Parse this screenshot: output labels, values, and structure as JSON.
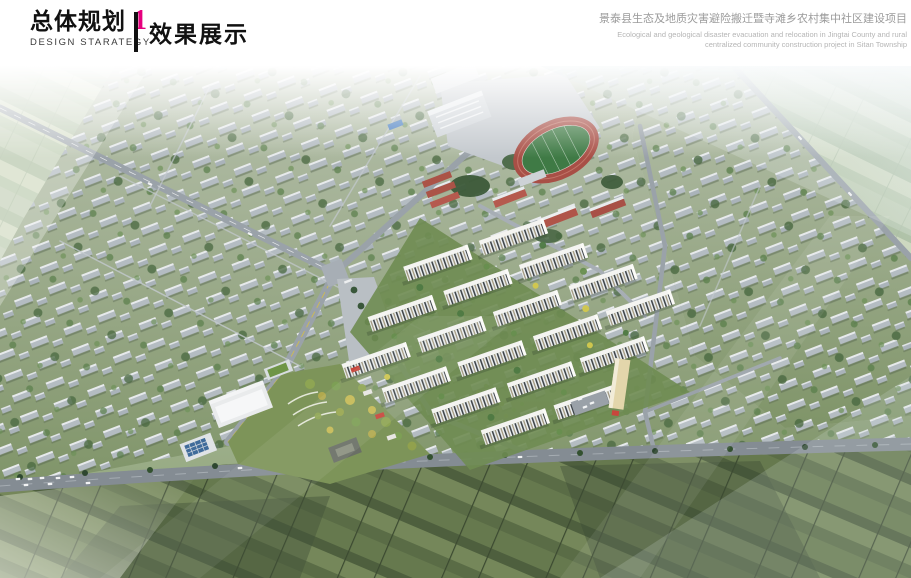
{
  "header": {
    "section_title_zh": "总体规划",
    "section_number": "1",
    "section_title_en": "DESIGN STARATEGY",
    "page_title": "效果展示",
    "project_title_zh": "景泰县生态及地质灾害避险搬迁暨寺滩乡农村集中社区建设项目",
    "project_title_en": "Ecological and geological disaster evacuation and relocation in Jingtai County and rural centralized community construction project in Sitan Township"
  },
  "colors": {
    "accent_magenta": "#e6007e",
    "header_text": "#111111",
    "muted_project_title": "#9b9b9b",
    "muted_project_subtitle": "#b5b5b5",
    "track_red": "#a84f46",
    "field_green": "#3f7a45",
    "road_gray": "#9aa2a9"
  },
  "rendering": {
    "description": "Aerial perspective rendering of the Sitan Township centralized rural community: central mid-rise residential cluster with landscaped courtyards, school campus with running track, surrounding single-storey village house grid, central park and public buildings, bounded by farmland."
  }
}
